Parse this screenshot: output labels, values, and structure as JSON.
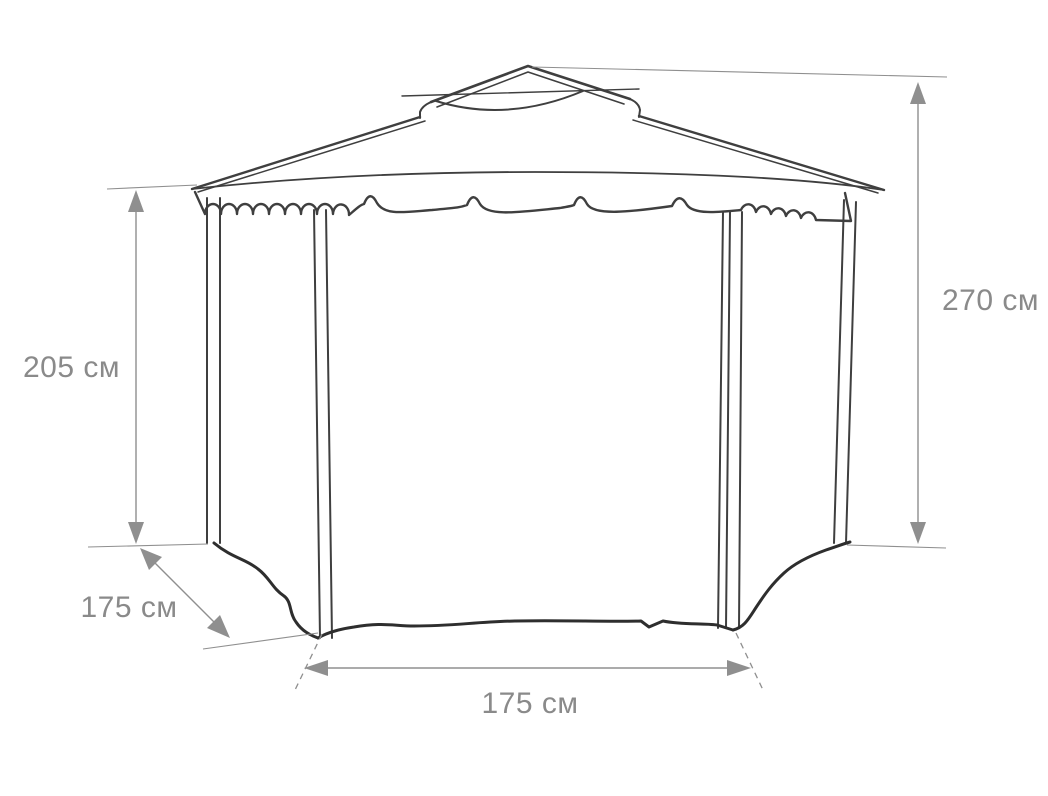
{
  "diagram": {
    "dimensions": {
      "left_height": "205 см",
      "right_height": "270 см",
      "side_depth": "175 см",
      "front_width": "175 см"
    },
    "colors": {
      "outline": "#3f3f3f",
      "fabric_edge": "#2e2e2e",
      "dimension_gray": "#8f8f8f",
      "label_gray": "#8a8a8a",
      "background": "#ffffff"
    }
  }
}
